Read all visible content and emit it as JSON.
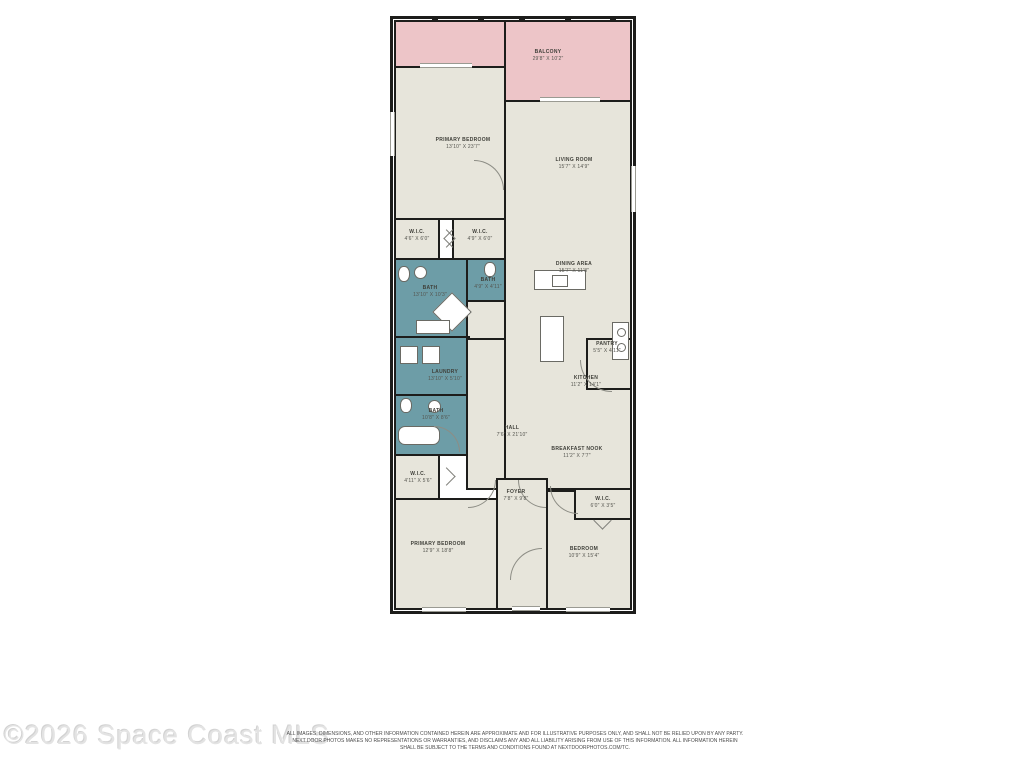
{
  "watermark": "©2026 Space Coast MLS",
  "disclaimer": {
    "line1": "ALL IMAGES, DIMENSIONS, AND OTHER INFORMATION CONTAINED HEREIN ARE APPROXIMATE AND FOR ILLUSTRATIVE PURPOSES ONLY, AND SHALL NOT BE RELIED UPON BY ANY PARTY.",
    "line2": "NEXT DOOR PHOTOS MAKES NO REPRESENTATIONS OR WARRANTIES, AND DISCLAIMS ANY AND ALL LIABILITY ARISING FROM USE OF THIS INFORMATION. ALL INFORMATION HEREIN",
    "line3": "SHALL BE SUBJECT TO THE TERMS AND CONDITIONS FOUND AT NEXTDOORPHOTOS.COM/TC."
  },
  "colors": {
    "room_fill": "#e7e5db",
    "balcony_fill": "#edc5c8",
    "wet_room_fill": "#6d9da7",
    "wall": "#1d1d1b"
  },
  "rooms": {
    "balcony": {
      "name": "BALCONY",
      "dims": "29'8\" X 10'2\""
    },
    "primary_bedroom_top": {
      "name": "PRIMARY BEDROOM",
      "dims": "13'10\" X 23'7\""
    },
    "living_room": {
      "name": "LIVING ROOM",
      "dims": "15'7\" X 14'9\""
    },
    "dining_area": {
      "name": "DINING AREA",
      "dims": "15'7\" X 11'8\""
    },
    "wic_top_left": {
      "name": "W.I.C.",
      "dims": "4'6\" X 6'0\""
    },
    "wic_top_right": {
      "name": "W.I.C.",
      "dims": "4'9\" X 6'0\""
    },
    "bath_primary": {
      "name": "BATH",
      "dims": "13'10\" X 10'3\""
    },
    "bath_small": {
      "name": "BATH",
      "dims": "4'9\" X 4'11\""
    },
    "laundry": {
      "name": "LAUNDRY",
      "dims": "13'10\" X 5'10\""
    },
    "bath_lower": {
      "name": "BATH",
      "dims": "10'8\" X 8'6\""
    },
    "hall": {
      "name": "HALL",
      "dims": "7'6\" X 21'10\""
    },
    "pantry": {
      "name": "PANTRY",
      "dims": "5'5\" X 4'11\""
    },
    "kitchen": {
      "name": "KITCHEN",
      "dims": "11'2\" X 14'1\""
    },
    "breakfast_nook": {
      "name": "BREAKFAST NOOK",
      "dims": "11'2\" X 7'7\""
    },
    "wic_lower_left": {
      "name": "W.I.C.",
      "dims": "4'11\" X 5'6\""
    },
    "foyer": {
      "name": "FOYER",
      "dims": "7'8\" X 9'8\""
    },
    "wic_lower_right": {
      "name": "W.I.C.",
      "dims": "6'0\" X 3'5\""
    },
    "primary_bedroom_bottom": {
      "name": "PRIMARY BEDROOM",
      "dims": "12'9\" X 18'8\""
    },
    "bedroom": {
      "name": "BEDROOM",
      "dims": "10'9\" X 15'4\""
    }
  }
}
